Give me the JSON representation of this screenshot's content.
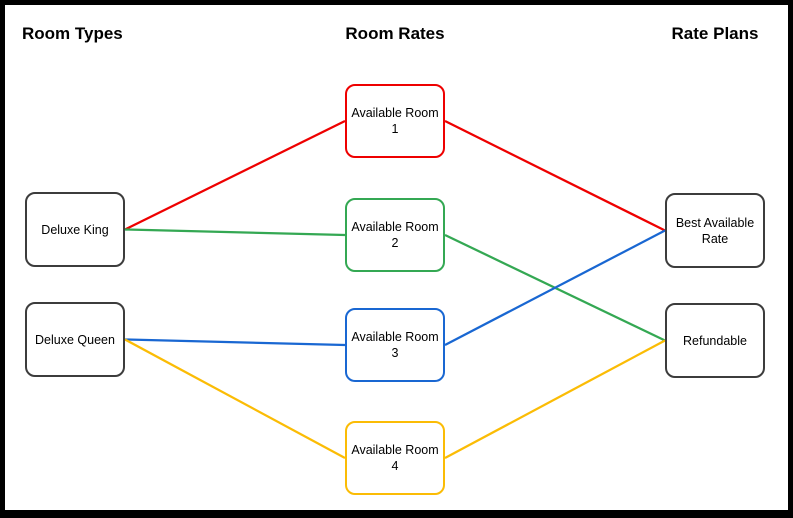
{
  "headings": [
    {
      "id": "room-types",
      "label": "Room Types"
    },
    {
      "id": "room-rates",
      "label": "Room Rates"
    },
    {
      "id": "rate-plans",
      "label": "Rate Plans"
    }
  ],
  "nodes": {
    "deluxe_king": {
      "label": "Deluxe King",
      "border_color": "#3c3c3c"
    },
    "deluxe_queen": {
      "label": "Deluxe Queen",
      "border_color": "#3c3c3c"
    },
    "available_room_1": {
      "label": "Available Room 1",
      "border_color": "#ee0000"
    },
    "available_room_2": {
      "label": "Available Room 2",
      "border_color": "#34a853"
    },
    "available_room_3": {
      "label": "Available Room 3",
      "border_color": "#1967d2"
    },
    "available_room_4": {
      "label": "Available Room 4",
      "border_color": "#fbbc05"
    },
    "best_available_rate": {
      "label": "Best Available Rate",
      "border_color": "#3c3c3c"
    },
    "refundable": {
      "label": "Refundable",
      "border_color": "#3c3c3c"
    }
  },
  "edges": [
    {
      "from": "deluxe_king",
      "to": "available_room_1",
      "color": "#ee0000"
    },
    {
      "from": "deluxe_king",
      "to": "available_room_2",
      "color": "#34a853"
    },
    {
      "from": "deluxe_queen",
      "to": "available_room_3",
      "color": "#1967d2"
    },
    {
      "from": "deluxe_queen",
      "to": "available_room_4",
      "color": "#fbbc05"
    },
    {
      "from": "available_room_1",
      "to": "best_available_rate",
      "color": "#ee0000"
    },
    {
      "from": "available_room_2",
      "to": "refundable",
      "color": "#34a853"
    },
    {
      "from": "available_room_3",
      "to": "best_available_rate",
      "color": "#1967d2"
    },
    {
      "from": "available_room_4",
      "to": "refundable",
      "color": "#fbbc05"
    }
  ],
  "colors": {
    "red": "#ee0000",
    "green": "#34a853",
    "blue": "#1967d2",
    "yellow": "#fbbc05",
    "node_border_dark": "#3c3c3c",
    "frame_border": "#000000",
    "background": "#ffffff"
  }
}
